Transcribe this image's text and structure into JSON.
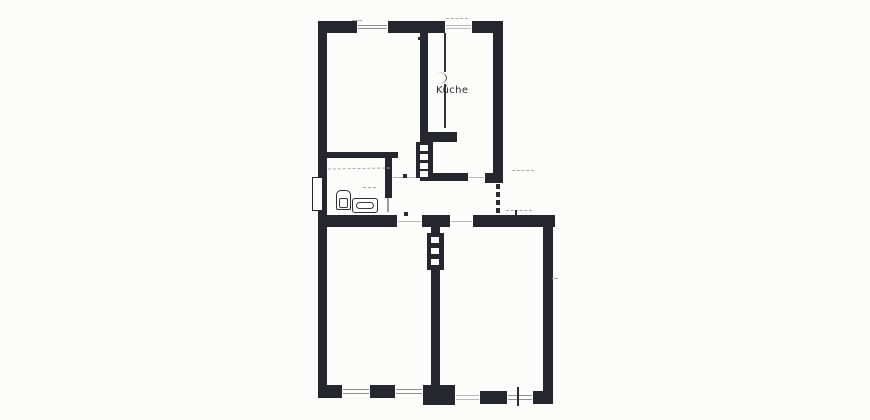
{
  "labels": {
    "kitchen": {
      "text": "Küche",
      "x": 436,
      "y": 85
    }
  },
  "palette": {
    "wall": "#26262e",
    "paper": "#fcfcfb",
    "window_line": "#8f8f96",
    "faint_mark": "#a8a8ae"
  },
  "plan": {
    "walls": [
      {
        "x": 318,
        "y": 21,
        "w": 39,
        "h": 12
      },
      {
        "x": 388,
        "y": 21,
        "w": 57,
        "h": 12
      },
      {
        "x": 472,
        "y": 21,
        "w": 31,
        "h": 12
      },
      {
        "x": 318,
        "y": 21,
        "w": 9,
        "h": 377
      },
      {
        "x": 493,
        "y": 21,
        "w": 10,
        "h": 160
      },
      {
        "x": 543,
        "y": 227,
        "w": 10,
        "h": 177
      },
      {
        "x": 420,
        "y": 33,
        "w": 8,
        "h": 109
      },
      {
        "x": 420,
        "y": 132,
        "w": 37,
        "h": 10
      },
      {
        "x": 318,
        "y": 152,
        "w": 80,
        "h": 6
      },
      {
        "x": 385,
        "y": 158,
        "w": 7,
        "h": 40
      },
      {
        "x": 420,
        "y": 173,
        "w": 48,
        "h": 8
      },
      {
        "x": 485,
        "y": 173,
        "w": 18,
        "h": 10
      },
      {
        "x": 318,
        "y": 215,
        "w": 79,
        "h": 12
      },
      {
        "x": 422,
        "y": 215,
        "w": 28,
        "h": 12
      },
      {
        "x": 473,
        "y": 215,
        "w": 82,
        "h": 12
      },
      {
        "x": 431,
        "y": 227,
        "w": 9,
        "h": 171
      },
      {
        "x": 318,
        "y": 385,
        "w": 24,
        "h": 13
      },
      {
        "x": 370,
        "y": 385,
        "w": 25,
        "h": 13
      },
      {
        "x": 423,
        "y": 385,
        "w": 32,
        "h": 20
      },
      {
        "x": 480,
        "y": 391,
        "w": 27,
        "h": 13
      },
      {
        "x": 533,
        "y": 391,
        "w": 20,
        "h": 13
      }
    ],
    "thin_walls": [
      {
        "x": 444,
        "y": 33,
        "w": 2,
        "h": 39
      },
      {
        "x": 444,
        "y": 84,
        "w": 2,
        "h": 44
      }
    ],
    "windows": [
      {
        "x": 357,
        "y": 22,
        "w": 31,
        "h": 10
      },
      {
        "x": 445,
        "y": 22,
        "w": 27,
        "h": 10,
        "faint": true
      },
      {
        "x": 342,
        "y": 386,
        "w": 28,
        "h": 11
      },
      {
        "x": 395,
        "y": 386,
        "w": 28,
        "h": 11
      },
      {
        "x": 455,
        "y": 392,
        "w": 25,
        "h": 11,
        "faint": true
      },
      {
        "x": 507,
        "y": 392,
        "w": 26,
        "h": 11
      }
    ],
    "doors": [
      {
        "x": 392,
        "y": 174,
        "w": 28,
        "h": 6
      },
      {
        "x": 468,
        "y": 174,
        "w": 17,
        "h": 6
      },
      {
        "x": 397,
        "y": 216,
        "w": 25,
        "h": 10
      },
      {
        "x": 450,
        "y": 216,
        "w": 23,
        "h": 10
      }
    ],
    "flue_blocks": [
      {
        "x": 416,
        "y": 142,
        "w": 17,
        "h": 36,
        "flues": [
          {
            "x": 420,
            "y": 145,
            "w": 8,
            "h": 6
          },
          {
            "x": 420,
            "y": 154,
            "w": 8,
            "h": 6
          },
          {
            "x": 420,
            "y": 163,
            "w": 8,
            "h": 6
          },
          {
            "x": 420,
            "y": 171,
            "w": 8,
            "h": 6
          }
        ]
      },
      {
        "x": 427,
        "y": 233,
        "w": 17,
        "h": 37,
        "flues": [
          {
            "x": 431,
            "y": 237,
            "w": 8,
            "h": 6
          },
          {
            "x": 431,
            "y": 248,
            "w": 8,
            "h": 6
          },
          {
            "x": 431,
            "y": 259,
            "w": 8,
            "h": 6
          }
        ]
      }
    ],
    "entrance_dashes": [
      {
        "x": 496,
        "y": 184,
        "w": 4,
        "h": 5
      },
      {
        "x": 496,
        "y": 192,
        "w": 4,
        "h": 5
      },
      {
        "x": 496,
        "y": 200,
        "w": 4,
        "h": 5
      },
      {
        "x": 496,
        "y": 208,
        "w": 4,
        "h": 5
      }
    ],
    "outline_boxes": [
      {
        "x": 312,
        "y": 177,
        "w": 11,
        "h": 34
      }
    ],
    "marks": [
      {
        "x": 328,
        "y": 168,
        "w": 62,
        "h": 6,
        "cls": "scrib",
        "rot": -1
      },
      {
        "x": 446,
        "y": 18,
        "w": 22,
        "h": 3,
        "cls": "scrib"
      },
      {
        "x": 352,
        "y": 20,
        "w": 10,
        "h": 3,
        "cls": "scrib"
      },
      {
        "x": 512,
        "y": 170,
        "w": 22,
        "h": 4,
        "cls": "scrib"
      },
      {
        "x": 506,
        "y": 210,
        "w": 26,
        "h": 3,
        "cls": "scrib"
      },
      {
        "x": 363,
        "y": 187,
        "w": 13,
        "h": 4,
        "cls": "scrib"
      },
      {
        "x": 552,
        "y": 278,
        "w": 6,
        "h": 2,
        "cls": "scrib"
      },
      {
        "x": 403,
        "y": 174,
        "w": 4,
        "h": 4,
        "cls": "dot"
      },
      {
        "x": 404,
        "y": 212,
        "w": 4,
        "h": 4,
        "cls": "dot"
      },
      {
        "x": 515,
        "y": 210,
        "w": 2,
        "h": 6,
        "cls": "dot"
      },
      {
        "x": 517,
        "y": 387,
        "w": 2,
        "h": 19,
        "cls": "dot"
      },
      {
        "x": 418,
        "y": 37,
        "w": 3,
        "h": 3,
        "cls": "dot"
      },
      {
        "x": 387,
        "y": 198,
        "w": 2,
        "h": 14,
        "cls": "thin"
      },
      {
        "x": 437,
        "y": 72,
        "w": 9,
        "h": 12,
        "cls": "arc"
      }
    ],
    "fixtures": {
      "toilet": {
        "x": 336,
        "y": 190,
        "w": 15,
        "h": 20
      },
      "tub": {
        "x": 352,
        "y": 198,
        "w": 26,
        "h": 15
      }
    },
    "rooms": [
      {
        "name": "room-upper-left",
        "x": 327,
        "y": 33,
        "w": 93,
        "h": 140
      },
      {
        "name": "room-kitchen",
        "x": 447,
        "y": 33,
        "w": 46,
        "h": 140
      },
      {
        "name": "room-bathroom",
        "x": 327,
        "y": 158,
        "w": 58,
        "h": 55
      },
      {
        "name": "hallway",
        "x": 392,
        "y": 183,
        "w": 101,
        "h": 32
      },
      {
        "name": "room-lower-left",
        "x": 327,
        "y": 227,
        "w": 104,
        "h": 158
      },
      {
        "name": "room-lower-right",
        "x": 440,
        "y": 227,
        "w": 103,
        "h": 164
      }
    ]
  }
}
